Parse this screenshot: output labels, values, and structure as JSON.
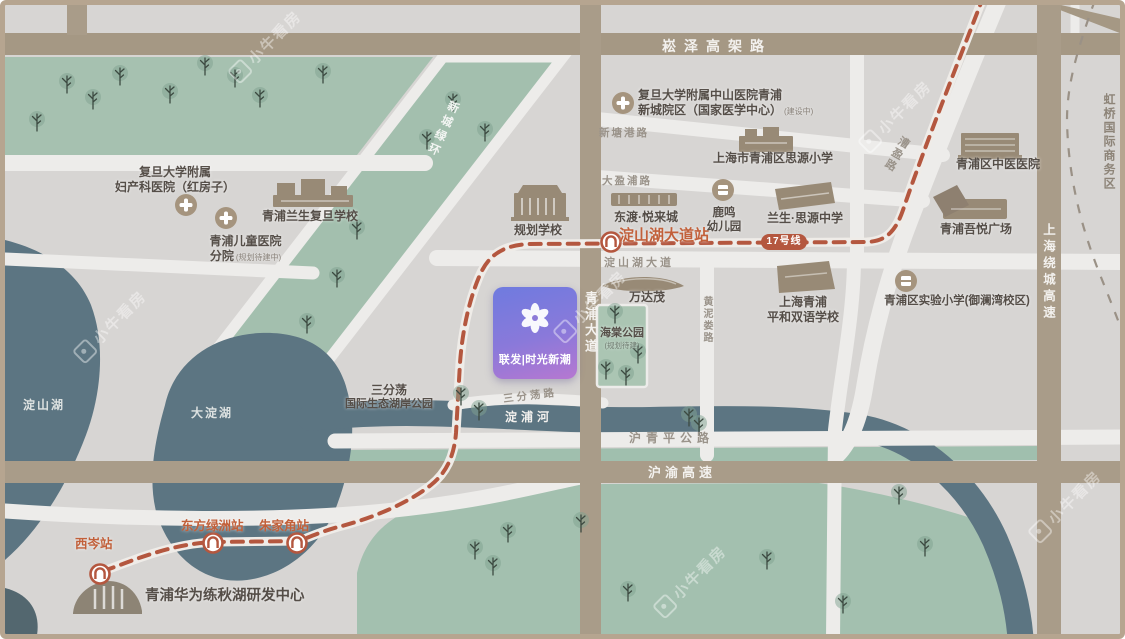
{
  "watermark": {
    "text": "小牛看房"
  },
  "property": {
    "name": "联发|时光新潮"
  },
  "metro": {
    "badge": "17号线",
    "stations": {
      "dianshanhu": "淀山湖大道站",
      "dongfanglvzhou": "东方绿洲站",
      "zhujiajiao": "朱家角站",
      "xicen": "西岑站"
    }
  },
  "roads": {
    "songze": "崧泽高架路",
    "qingpu_ave": "青浦大道",
    "huyu": "沪渝高速",
    "huqingping": "沪青平公路",
    "raocheng": "上海绕城高速",
    "xintanggang": "新塘港路",
    "dayingpu": "大盈浦路",
    "dianshanhu_ave": "淀山湖大道",
    "caoying": "漕盈路",
    "huangnilou": "黄泥娄路",
    "sanfendang": "三分荡路",
    "xincheng_ring": "新城绿环"
  },
  "water": {
    "dianshan_lake": "淀山湖",
    "dadian_lake": "大淀湖",
    "dianpu_river": "淀浦河"
  },
  "districts": {
    "hongqiao_cbd": "虹桥国际商务区"
  },
  "pois": {
    "zhongshan_hospital": {
      "line1": "复旦大学附属中山医院青浦",
      "line2": "新城院区（国家医学中心）",
      "note": "(建设中)"
    },
    "fuchan_hospital": {
      "line1": "复旦大学附属",
      "line2": "妇产科医院（红房子）"
    },
    "children_hospital": {
      "line1": "青浦儿童医院",
      "line2": "分院",
      "note": "(规划待建中)"
    },
    "lansheng_fudan_school": {
      "name": "青浦兰生复旦学校"
    },
    "guihua_school": {
      "name": "规划学校"
    },
    "dongdu_yuelai": {
      "name": "东渡·悦来城"
    },
    "luming_kindergarten": {
      "line1": "鹿鸣",
      "line2": "幼儿园"
    },
    "siyuan_primary": {
      "name": "上海市青浦区思源小学"
    },
    "lansheng_siyuan_middle": {
      "name": "兰生·思源中学"
    },
    "zhongyi_hospital": {
      "name": "青浦区中医医院"
    },
    "wuyue_plaza": {
      "name": "青浦吾悦广场"
    },
    "shiyan_primary": {
      "name": "青浦区实验小学(御澜湾校区)"
    },
    "pinghe_school": {
      "line1": "上海青浦",
      "line2": "平和双语学校"
    },
    "wandamao": {
      "name": "万达茂"
    },
    "haitang_park": {
      "name": "海棠公园",
      "note": "(规划待建)"
    },
    "sanfendang_park": {
      "line1": "三分荡",
      "line2": "国际生态湖岸公园"
    },
    "huawei_center": {
      "name": "青浦华为练秋湖研发中心"
    }
  },
  "colors": {
    "metro_line": "#b4573f",
    "station_text": "#c2603a",
    "property_gradient_start": "#6f7bdf",
    "property_gradient_end": "#b678d1",
    "water": "#5c7582",
    "green": "#a6c1b0",
    "highway": "#a99c89"
  }
}
